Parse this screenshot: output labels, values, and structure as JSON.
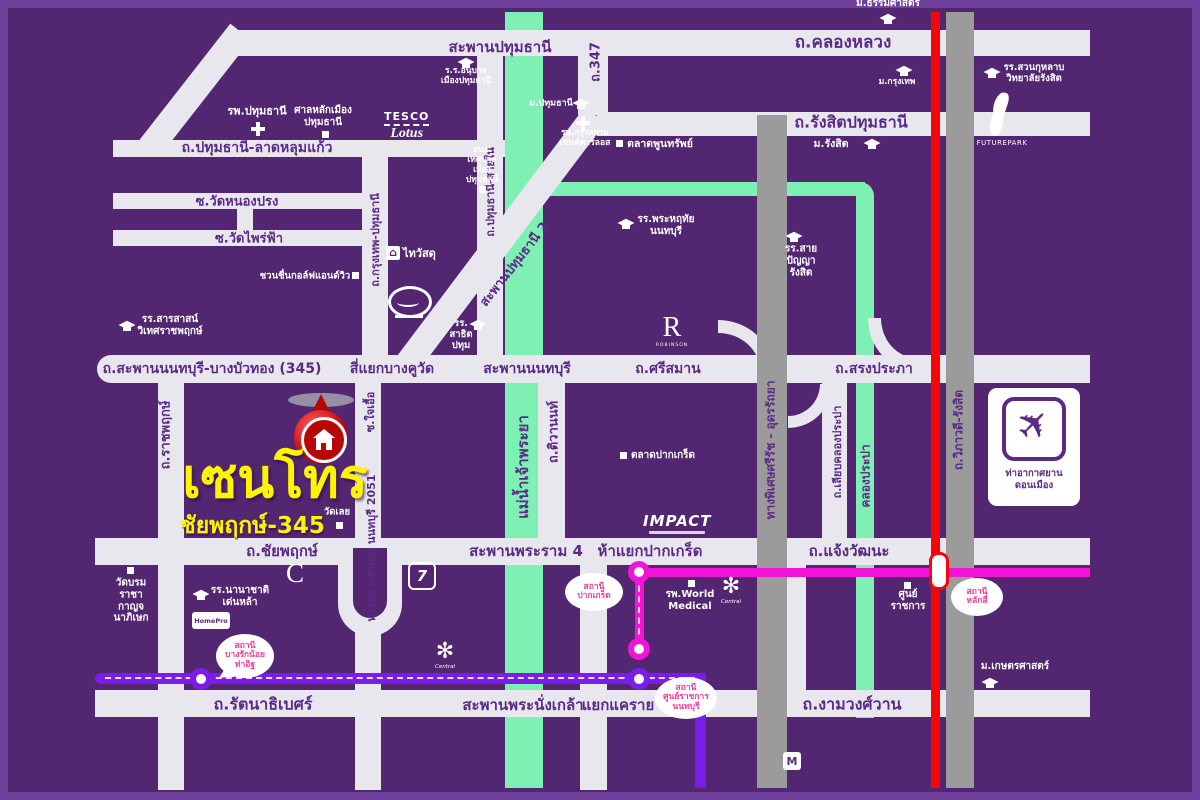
{
  "title": "Centro Chaiyaphruek-345 location map",
  "colors": {
    "background": "#522671",
    "road": "#e9e7ee",
    "river": "#7ff0b4",
    "tollway": "#9b9b9b",
    "rail_red": "#f20808",
    "mrt_pink": "#f414d7",
    "mrt_purple": "#7a1de8",
    "logo_yellow": "#fdf400",
    "road_label": "#5b2a86",
    "bubble_text": "#ee3f9b"
  },
  "project": {
    "name": "เซนโทร",
    "sub": "ชัยพฤกษ์-345"
  },
  "logos": {
    "tesco_top": "TESCO",
    "tesco_bottom": "Lotus",
    "thaiwatsadu": "ไทวัสดุ",
    "robinson_r": "R",
    "robinson_sub": "ROBINSON",
    "impact": "IMPACT",
    "futurepark": "FUTUREPARK",
    "airport": "ท่าอากาศยาน\nดอนเมือง",
    "seven": "7",
    "homepro": "HomePro",
    "c_logo": "C",
    "central": "Central",
    "mall": "M"
  },
  "map": {
    "road_labels": [
      {
        "t": "สะพานปทุมธานี",
        "x": 500,
        "y": 47,
        "s": 15
      },
      {
        "t": "ถ.คลองหลวง",
        "x": 843,
        "y": 42,
        "s": 17
      },
      {
        "t": "ถ.347",
        "x": 595,
        "y": 62,
        "s": 13,
        "r": -90
      },
      {
        "t": "ถ.รัง​สิตปทุมธานี",
        "x": 851,
        "y": 123,
        "s": 16
      },
      {
        "t": "ถ.ปทุมธานี-ลาดหลุมแก้ว",
        "x": 257,
        "y": 148,
        "s": 14
      },
      {
        "t": "ซ.วัดหนองปรง",
        "x": 237,
        "y": 201,
        "s": 13
      },
      {
        "t": "ซ.วัดไพร่ฟ้า",
        "x": 249,
        "y": 238,
        "s": 13
      },
      {
        "t": "ถ.ปทุมธานี-สายใน",
        "x": 490,
        "y": 192,
        "s": 11,
        "r": -90
      },
      {
        "t": "ถ.กรุงเทพ-ปทุมธานี",
        "x": 375,
        "y": 240,
        "s": 11,
        "r": -90
      },
      {
        "t": "สะพานปทุมธานี 2",
        "x": 514,
        "y": 264,
        "s": 13,
        "r": -52
      },
      {
        "t": "ถ.สะพานนนทบุรี-บางบัวทอง (345)",
        "x": 212,
        "y": 369,
        "s": 14
      },
      {
        "t": "สี่แยกบางคูวัด",
        "x": 392,
        "y": 369,
        "s": 14
      },
      {
        "t": "สะพานนนทบุรี",
        "x": 527,
        "y": 369,
        "s": 14
      },
      {
        "t": "ถ.ศรีสมาน",
        "x": 668,
        "y": 369,
        "s": 14
      },
      {
        "t": "ถ.สรงประภา",
        "x": 874,
        "y": 369,
        "s": 14
      },
      {
        "t": "แม่น้ำเจ้าพระยา",
        "x": 523,
        "y": 467,
        "s": 15,
        "r": -90
      },
      {
        "t": "ถ.ติวานนท์",
        "x": 553,
        "y": 432,
        "s": 13,
        "r": -90
      },
      {
        "t": "ถ.ราชพฤกษ์",
        "x": 165,
        "y": 435,
        "s": 13,
        "r": -90
      },
      {
        "t": "ซ.ใจเอื้อ",
        "x": 370,
        "y": 412,
        "s": 11,
        "r": -90
      },
      {
        "t": "ทางหลวงชนบท นนทบุรี 2051",
        "x": 371,
        "y": 548,
        "s": 11,
        "r": -90
      },
      {
        "t": "ทางพิเศษศรีรัช - อุดรรัถยา",
        "x": 771,
        "y": 450,
        "s": 12,
        "r": -90
      },
      {
        "t": "ถ.เลียบคลองประปา",
        "x": 837,
        "y": 452,
        "s": 11,
        "r": -90
      },
      {
        "t": "คลองประปา",
        "x": 866,
        "y": 476,
        "s": 12,
        "r": -90
      },
      {
        "t": "ถ.วิภาวดี-รังสิต",
        "x": 959,
        "y": 430,
        "s": 12,
        "r": -90
      },
      {
        "t": "ถ.ชัยพฤกษ์",
        "x": 282,
        "y": 551,
        "s": 15
      },
      {
        "t": "สะพานพระราม 4",
        "x": 526,
        "y": 551,
        "s": 15
      },
      {
        "t": "ห้าแยกปากเกร็ด",
        "x": 650,
        "y": 551,
        "s": 15
      },
      {
        "t": "ถ.แจ้งวัฒนะ",
        "x": 849,
        "y": 551,
        "s": 15
      },
      {
        "t": "ถ.รัตนาธิเบศร์",
        "x": 263,
        "y": 705,
        "s": 16
      },
      {
        "t": "สะพานพระนั่งเกล้า",
        "x": 523,
        "y": 705,
        "s": 15
      },
      {
        "t": "แยกแคราย",
        "x": 618,
        "y": 705,
        "s": 15
      },
      {
        "t": "ถ.งามวงศ์วาน",
        "x": 852,
        "y": 705,
        "s": 16
      }
    ],
    "places": [
      {
        "t": "รพ.ปทุมธานี",
        "x": 257,
        "y": 112,
        "s": 11,
        "icon": "cross",
        "ix": 251,
        "iy": 122
      },
      {
        "t": "ศาลหลักเมือง\nปทุมธานี",
        "x": 323,
        "y": 117,
        "s": 10,
        "icon": "sq",
        "ix": 322,
        "iy": 131
      },
      {
        "t": "ร.ร.อนุบาล\nเมืองปทุมธานี",
        "x": 466,
        "y": 76,
        "s": 8.5,
        "icon": "cap",
        "ix": 458,
        "iy": 56
      },
      {
        "t": "สนง.\nเทศบาล\nเมือง\nปทุมธานี",
        "x": 482,
        "y": 165,
        "s": 8.5,
        "icon": "sq",
        "ix": 479,
        "iy": 186
      },
      {
        "t": "ม.ปทุมธานี",
        "x": 551,
        "y": 104,
        "s": 9,
        "icon": "cap",
        "ix": 573,
        "iy": 97
      },
      {
        "t": "รพ.กรุงสยาม\nเซนต์คาร์ลอส",
        "x": 585,
        "y": 138,
        "s": 8.5,
        "icon": "cross",
        "ix": 576,
        "iy": 116
      },
      {
        "t": "ตลาดพูนทรัพย์",
        "x": 660,
        "y": 144,
        "s": 10.5,
        "icon": "sq",
        "ix": 616,
        "iy": 140
      },
      {
        "t": "ม.ธรรมศาสตร์",
        "x": 888,
        "y": 4,
        "s": 10,
        "icon": "cap",
        "ix": 880,
        "iy": 12
      },
      {
        "t": "ม.กรุงเทพ",
        "x": 897,
        "y": 82,
        "s": 8.5,
        "icon": "cap",
        "ix": 896,
        "iy": 64
      },
      {
        "t": "รร.สวนกุหลาบ\nวิทยาลัยรังสิต",
        "x": 1034,
        "y": 73,
        "s": 9.5,
        "icon": "cap",
        "ix": 984,
        "iy": 66
      },
      {
        "t": "ม.รังสิต",
        "x": 831,
        "y": 144,
        "s": 10.5,
        "icon": "cap",
        "ix": 864,
        "iy": 137
      },
      {
        "t": "รร.พระหฤทัย\nนนทบุรี",
        "x": 666,
        "y": 226,
        "s": 10,
        "icon": "cap",
        "ix": 618,
        "iy": 217
      },
      {
        "t": "รร.สาย\nปัญญา\nรังสิต",
        "x": 801,
        "y": 261,
        "s": 10,
        "icon": "cap",
        "ix": 786,
        "iy": 230
      },
      {
        "t": "ชวนชื่นกอล์ฟแอนด์วิว",
        "x": 305,
        "y": 276,
        "s": 9.5,
        "icon": "sq",
        "ix": 352,
        "iy": 272
      },
      {
        "t": "รร.สารสาสน์\nวิเทศราชพฤกษ์",
        "x": 170,
        "y": 326,
        "s": 10,
        "icon": "cap",
        "ix": 119,
        "iy": 319
      },
      {
        "t": "รร.\nสาธิต\nปทุม",
        "x": 461,
        "y": 335,
        "s": 9.5,
        "icon": "cap",
        "ix": 470,
        "iy": 318
      },
      {
        "t": "วัดเลย",
        "x": 337,
        "y": 512,
        "s": 9.5,
        "icon": "sq",
        "ix": 336,
        "iy": 522
      },
      {
        "t": "ตลาดปากเกร็ด",
        "x": 663,
        "y": 456,
        "s": 10,
        "icon": "sq",
        "ix": 620,
        "iy": 452
      },
      {
        "t": "วัดบรม\nราชา\nกาญจ\nนาภิเษก",
        "x": 131,
        "y": 601,
        "s": 10,
        "icon": "sq",
        "ix": 127,
        "iy": 567
      },
      {
        "t": "รร.นานาชาติ\nเด่นหล้า",
        "x": 240,
        "y": 597,
        "s": 10,
        "icon": "cap",
        "ix": 193,
        "iy": 588
      },
      {
        "t": "รพ.World\nMedical",
        "x": 690,
        "y": 601,
        "s": 10,
        "icon": "sq",
        "ix": 688,
        "iy": 580
      },
      {
        "t": "ศูนย์\nราชการ",
        "x": 908,
        "y": 601,
        "s": 10,
        "icon": "sq",
        "ix": 904,
        "iy": 582
      },
      {
        "t": "ม.เกษตรศาสตร์",
        "x": 1015,
        "y": 667,
        "s": 10,
        "icon": "cap",
        "ix": 982,
        "iy": 676
      }
    ],
    "stations": [
      {
        "x": 201,
        "y": 679,
        "c": "#7a1de8"
      },
      {
        "x": 639,
        "y": 572,
        "c": "#f414d7"
      },
      {
        "x": 639,
        "y": 649,
        "c": "#f414d7"
      },
      {
        "x": 639,
        "y": 679,
        "c": "#7a1de8"
      }
    ],
    "bubbles": [
      {
        "t": "สถานี\nบางรักน้อย\nท่าอิฐ",
        "x": 245,
        "y": 656,
        "w": 58,
        "h": 44,
        "tail": {
          "x": 215,
          "y": 666,
          "r": 60
        }
      },
      {
        "t": "สถานี\nปากเกร็ด",
        "x": 594,
        "y": 592,
        "w": 58,
        "h": 38,
        "tail": {
          "x": 612,
          "y": 578,
          "r": 245
        }
      },
      {
        "t": "สถานี\nศูนย์ราชการ\nนนทบุรี",
        "x": 686,
        "y": 698,
        "w": 62,
        "h": 42,
        "tail": {
          "x": 655,
          "y": 684,
          "r": 115
        }
      },
      {
        "t": "สถานี\nหลักสี่",
        "x": 977,
        "y": 597,
        "w": 52,
        "h": 38,
        "tail": {
          "x": 950,
          "y": 580,
          "r": 120
        }
      }
    ]
  }
}
